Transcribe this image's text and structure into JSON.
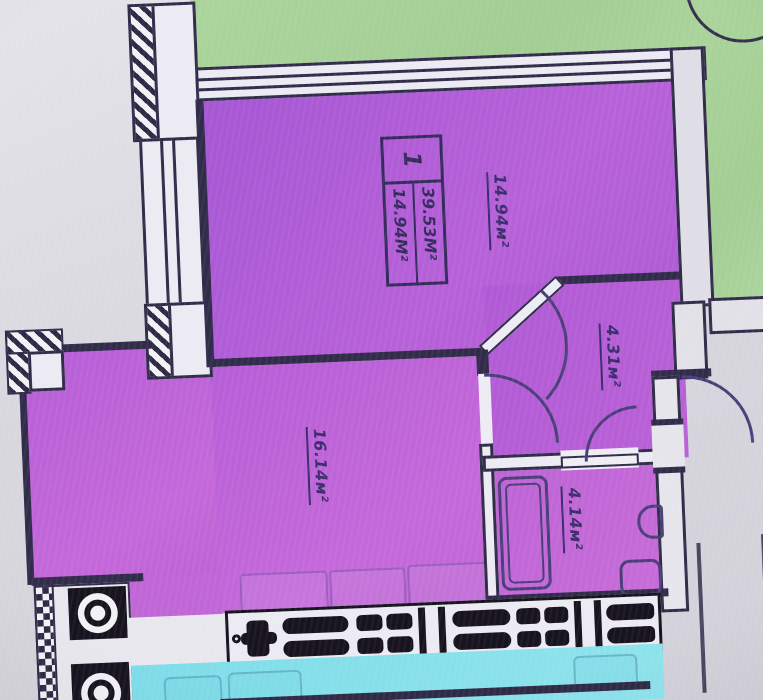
{
  "plan": {
    "title": "apartment floor plan photo",
    "unit_stamp": {
      "number": "1",
      "total_area": "39.53М²",
      "living_area": "14.94М²"
    },
    "rooms": [
      {
        "id": "living-room",
        "area_label": "14.94м²"
      },
      {
        "id": "bedroom",
        "area_label": "16.14м²"
      },
      {
        "id": "hallway",
        "area_label": "4.31м²"
      },
      {
        "id": "bathroom",
        "area_label": "4.14м²"
      }
    ],
    "colors": {
      "room_fill_purple": "#b75fd8",
      "outdoor_green": "#a8d29a",
      "lower_unit_cyan": "#7edde9",
      "wall_ink": "#312c4a",
      "label_ink": "#3b2e6d",
      "background": "#d7d6dd"
    }
  }
}
